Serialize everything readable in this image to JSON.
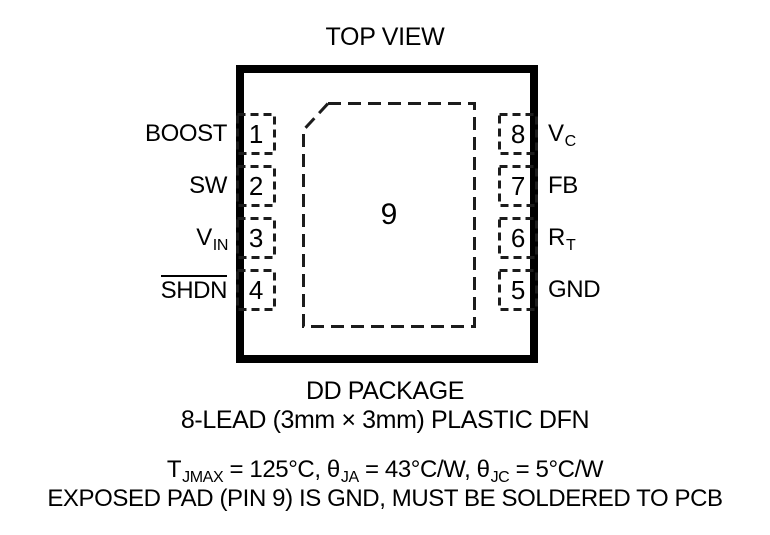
{
  "title": "TOP VIEW",
  "package": {
    "exposed_pad_number": "9",
    "pins_left": [
      {
        "number": "1",
        "label": "BOOST",
        "sub": "",
        "overline": false
      },
      {
        "number": "2",
        "label": "SW",
        "sub": "",
        "overline": false
      },
      {
        "number": "3",
        "label": "V",
        "sub": "IN",
        "overline": false
      },
      {
        "number": "4",
        "label": "SHDN",
        "sub": "",
        "overline": true
      }
    ],
    "pins_right": [
      {
        "number": "8",
        "label": "V",
        "sub": "C"
      },
      {
        "number": "7",
        "label": "FB",
        "sub": ""
      },
      {
        "number": "6",
        "label": "R",
        "sub": "T"
      },
      {
        "number": "5",
        "label": "GND",
        "sub": ""
      }
    ]
  },
  "captions": {
    "package_name": "DD PACKAGE",
    "package_description": "8-LEAD (3mm × 3mm) PLASTIC DFN"
  },
  "notes": {
    "thermal": {
      "t1": "T",
      "s1": "JMAX",
      "t2": " = 125°C, θ",
      "s2": "JA",
      "t3": " = 43°C/W, θ",
      "s3": "JC",
      "t4": " = 5°C/W"
    },
    "exposed_pad_note": "EXPOSED PAD (PIN 9) IS GND, MUST BE SOLDERED TO PCB"
  },
  "colors": {
    "ink": "#000000",
    "dash": "#1c1c1c",
    "background": "#ffffff"
  }
}
